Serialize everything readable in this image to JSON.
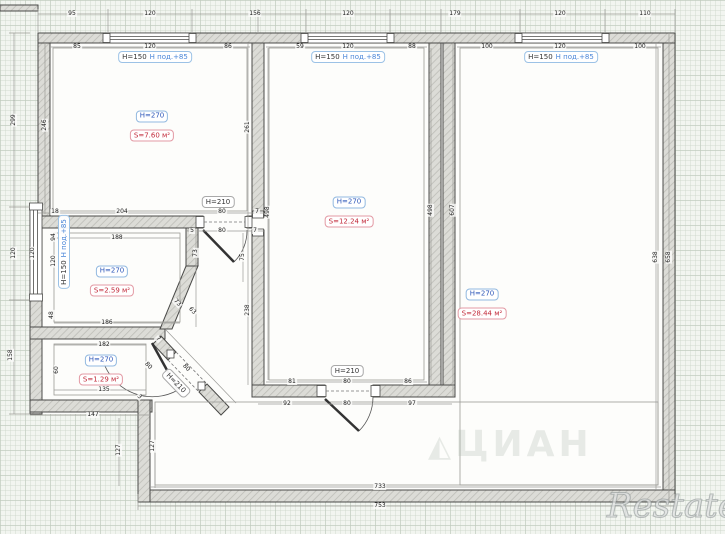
{
  "plan": {
    "rooms": [
      {
        "height_label": "H=270",
        "area_label": "S=7.60 м²",
        "x": 152,
        "y": 122
      },
      {
        "height_label": "H=270",
        "area_label": "S=12.24 м²",
        "x": 349,
        "y": 208
      },
      {
        "height_label": "H=270",
        "area_label": "S=28.44 м²",
        "x": 482,
        "y": 300
      },
      {
        "height_label": "H=270",
        "area_label": "S=2.59 м²",
        "x": 112,
        "y": 277
      },
      {
        "height_label": "H=270",
        "area_label": "S=1.29 м²",
        "x": 101,
        "y": 366
      }
    ],
    "windows": [
      {
        "height_label": "H=150",
        "sill_label": "Н под.+85",
        "x": 155,
        "y": 57,
        "r": 0
      },
      {
        "height_label": "H=150",
        "sill_label": "Н под.+85",
        "x": 348,
        "y": 57,
        "r": 0
      },
      {
        "height_label": "H=150",
        "sill_label": "Н под.+85",
        "x": 561,
        "y": 57,
        "r": 0
      },
      {
        "height_label": "H=150",
        "sill_label": "Н под.+85",
        "x": 64,
        "y": 252,
        "r": -90
      }
    ],
    "doors": [
      {
        "label": "H=210",
        "x": 218,
        "y": 202,
        "r": 0
      },
      {
        "label": "H=210",
        "x": 347,
        "y": 371,
        "r": 0
      },
      {
        "label": "H=210",
        "x": 176,
        "y": 383,
        "r": 46
      }
    ],
    "dimensions": [
      {
        "t": "95",
        "x": 72,
        "y": 14
      },
      {
        "t": "120",
        "x": 150,
        "y": 14
      },
      {
        "t": "156",
        "x": 255,
        "y": 14
      },
      {
        "t": "120",
        "x": 348,
        "y": 14
      },
      {
        "t": "179",
        "x": 455,
        "y": 14
      },
      {
        "t": "120",
        "x": 560,
        "y": 14
      },
      {
        "t": "110",
        "x": 645,
        "y": 14
      },
      {
        "t": "85",
        "x": 77,
        "y": 47
      },
      {
        "t": "120",
        "x": 150,
        "y": 47
      },
      {
        "t": "86",
        "x": 228,
        "y": 47
      },
      {
        "t": "59",
        "x": 300,
        "y": 47
      },
      {
        "t": "120",
        "x": 348,
        "y": 47
      },
      {
        "t": "88",
        "x": 412,
        "y": 47
      },
      {
        "t": "100",
        "x": 487,
        "y": 47
      },
      {
        "t": "120",
        "x": 560,
        "y": 47
      },
      {
        "t": "100",
        "x": 640,
        "y": 47
      },
      {
        "t": "299",
        "x": 14,
        "y": 120,
        "r": -90
      },
      {
        "t": "120",
        "x": 14,
        "y": 253,
        "r": -90
      },
      {
        "t": "158",
        "x": 11,
        "y": 355,
        "r": -90
      },
      {
        "t": "246",
        "x": 45,
        "y": 125,
        "r": -90
      },
      {
        "t": "261",
        "x": 248,
        "y": 127,
        "r": -90
      },
      {
        "t": "238",
        "x": 248,
        "y": 310,
        "r": -90
      },
      {
        "t": "498",
        "x": 268,
        "y": 212,
        "r": -90
      },
      {
        "t": "498",
        "x": 431,
        "y": 210,
        "r": -90
      },
      {
        "t": "607",
        "x": 453,
        "y": 210,
        "r": -90
      },
      {
        "t": "638",
        "x": 656,
        "y": 257,
        "r": -90
      },
      {
        "t": "658",
        "x": 669,
        "y": 257,
        "r": -90
      },
      {
        "t": "18",
        "x": 55,
        "y": 212
      },
      {
        "t": "204",
        "x": 122,
        "y": 212
      },
      {
        "t": "80",
        "x": 222,
        "y": 212
      },
      {
        "t": "7",
        "x": 257,
        "y": 212
      },
      {
        "t": "5",
        "x": 192,
        "y": 231
      },
      {
        "t": "80",
        "x": 222,
        "y": 231
      },
      {
        "t": "7",
        "x": 255,
        "y": 231
      },
      {
        "t": "188",
        "x": 117,
        "y": 238
      },
      {
        "t": "94",
        "x": 54,
        "y": 237,
        "r": -90
      },
      {
        "t": "120",
        "x": 54,
        "y": 261,
        "r": -90
      },
      {
        "t": "120",
        "x": 33,
        "y": 253,
        "r": -90
      },
      {
        "t": "48",
        "x": 52,
        "y": 315,
        "r": -90
      },
      {
        "t": "73",
        "x": 196,
        "y": 253,
        "r": -90
      },
      {
        "t": "75",
        "x": 243,
        "y": 257,
        "r": -90
      },
      {
        "t": "73",
        "x": 177,
        "y": 303,
        "r": 46
      },
      {
        "t": "63",
        "x": 192,
        "y": 311,
        "r": 46
      },
      {
        "t": "186",
        "x": 107,
        "y": 323
      },
      {
        "t": "182",
        "x": 104,
        "y": 345
      },
      {
        "t": "60",
        "x": 57,
        "y": 370,
        "r": -90
      },
      {
        "t": "135",
        "x": 104,
        "y": 390
      },
      {
        "t": "147",
        "x": 93,
        "y": 415
      },
      {
        "t": "7",
        "x": 158,
        "y": 339,
        "r": 46
      },
      {
        "t": "80",
        "x": 148,
        "y": 366,
        "r": 46
      },
      {
        "t": "80",
        "x": 186,
        "y": 368,
        "r": 46
      },
      {
        "t": "3",
        "x": 139,
        "y": 397,
        "r": 46
      },
      {
        "t": "127",
        "x": 119,
        "y": 450,
        "r": -90
      },
      {
        "t": "127",
        "x": 153,
        "y": 446,
        "r": -90
      },
      {
        "t": "81",
        "x": 292,
        "y": 382
      },
      {
        "t": "80",
        "x": 347,
        "y": 382
      },
      {
        "t": "86",
        "x": 408,
        "y": 382
      },
      {
        "t": "92",
        "x": 287,
        "y": 404
      },
      {
        "t": "80",
        "x": 347,
        "y": 404
      },
      {
        "t": "97",
        "x": 412,
        "y": 404
      },
      {
        "t": "733",
        "x": 380,
        "y": 487
      },
      {
        "t": "753",
        "x": 380,
        "y": 506
      }
    ]
  },
  "watermarks": {
    "center_logo": "◭",
    "center": "ЦИАН",
    "corner": "Restate"
  }
}
